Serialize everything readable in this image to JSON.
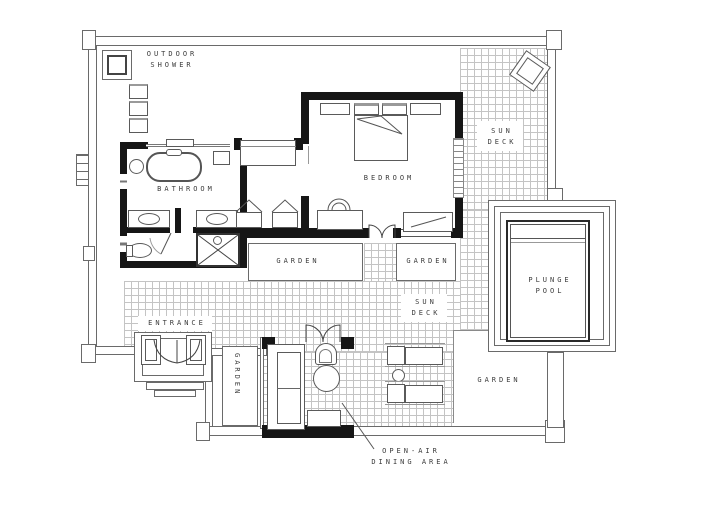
{
  "plan": {
    "title": "Villa floor plan with plunge pool",
    "areas": {
      "outdoor_shower": {
        "line1": "OUTDOOR",
        "line2": "SHOWER"
      },
      "bathroom": {
        "label": "BATHROOM"
      },
      "bedroom": {
        "label": "BEDROOM"
      },
      "sun_deck": {
        "line1": "SUN",
        "line2": "DECK"
      },
      "garden": {
        "label": "GARDEN"
      },
      "plunge_pool": {
        "line1": "PLUNGE",
        "line2": "POOL"
      },
      "entrance": {
        "label": "ENTRANCE"
      },
      "dining": {
        "line1": "OPEN-AIR",
        "line2": "DINING AREA"
      }
    },
    "colors": {
      "wall": "#161616",
      "fence_line": "#6a6a6a",
      "furniture_line": "#5a5a5a",
      "tile_line": "#c4c4c4",
      "text": "#3c3c3c",
      "pool_edge": "#2a2a2a"
    }
  }
}
